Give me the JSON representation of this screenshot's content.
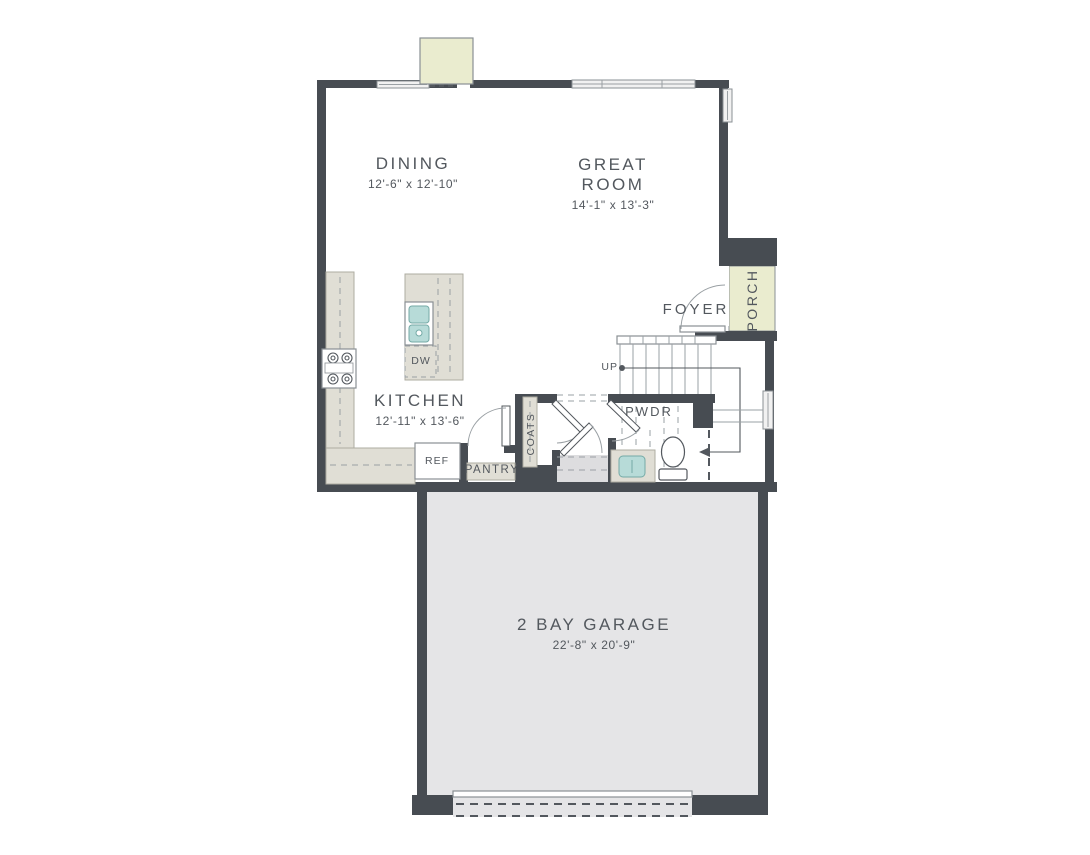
{
  "theme": {
    "wall": "#474c52",
    "text": "#53585e",
    "counter": "#e0ded5",
    "counter_edge": "#aeaca1",
    "garage": "#e5e5e7",
    "porch": "#eaeccf",
    "sink": "#b7dbd8",
    "sink_edge": "#74aaa6",
    "line": "#9aa0a4",
    "window": "#f1f1f1",
    "landing": "#dddddf",
    "edge": "#8a9094"
  },
  "labels": {
    "dining": {
      "name": "DINING",
      "dims": "12'-6\" x 12'-10\""
    },
    "great_room": {
      "name": "GREAT ROOM",
      "dims": "14'-1\" x 13'-3\""
    },
    "kitchen": {
      "name": "KITCHEN",
      "dims": "12'-11\" x 13'-6\""
    },
    "garage": {
      "name": "2 BAY GARAGE",
      "dims": "22'-8\" x 20'-9\""
    },
    "foyer": "FOYER",
    "porch": "PORCH",
    "powder_room": "PWDR",
    "coats": "COATS",
    "pantry": "PANTRY",
    "refrigerator": "REF",
    "dishwasher": "DW",
    "stairs_direction": "UP"
  }
}
